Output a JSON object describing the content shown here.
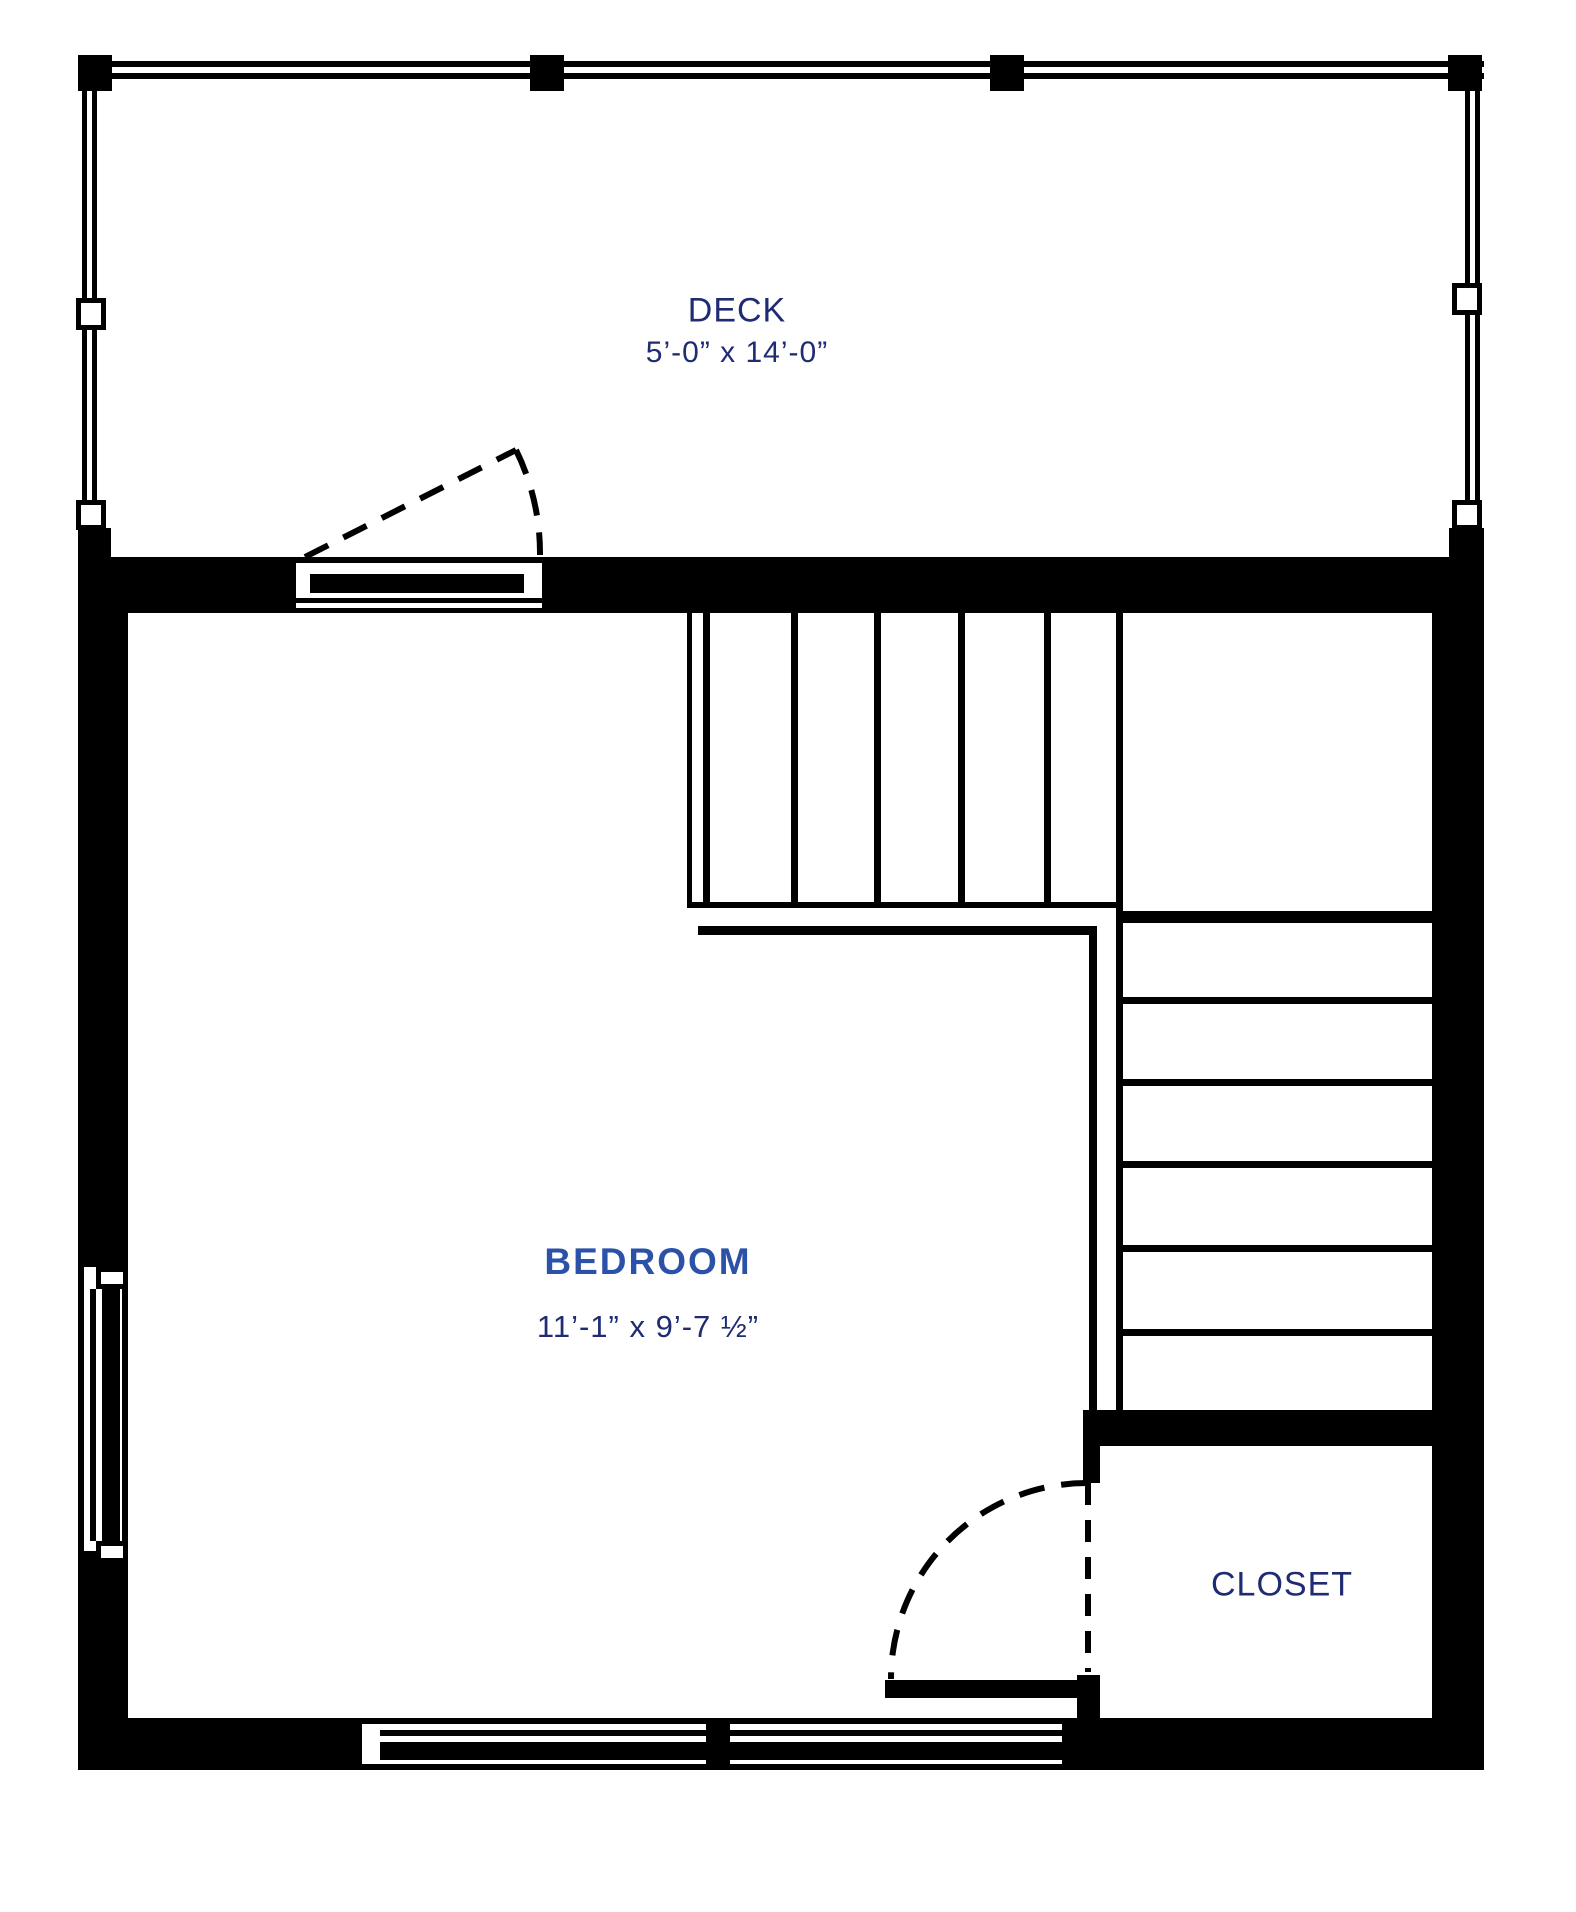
{
  "title": "Floor plan",
  "colors": {
    "line": "#000000",
    "background": "#ffffff",
    "room_label_accent": "#2b52a8",
    "room_label_navy": "#1f2c73"
  },
  "rooms": {
    "deck": {
      "label": "DECK",
      "dimensions": "5’-0” x 14’-0”"
    },
    "bedroom": {
      "label": "BEDROOM",
      "dimensions": "11’-1” x 9’-7 ½”"
    },
    "closet": {
      "label": "CLOSET"
    }
  }
}
